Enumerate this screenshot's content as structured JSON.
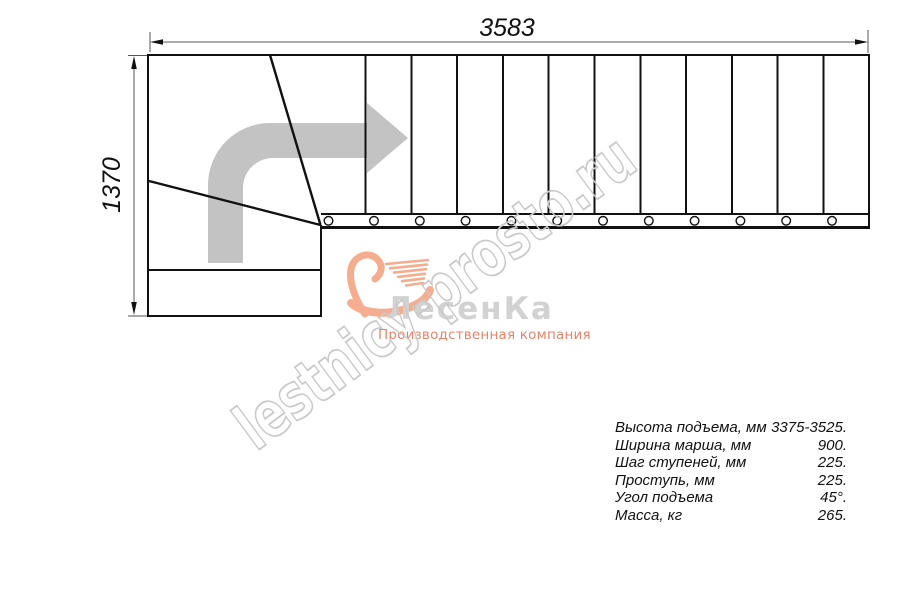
{
  "drawing": {
    "title": "staircase-top-view-plan",
    "dim_width_mm": "3583",
    "dim_height_mm": "1370",
    "straight_treads": 12,
    "baluster_count": 12,
    "line_color": "#111111",
    "dim_line_color": "#555555",
    "arrow_color": "#c3c3c3"
  },
  "watermark": {
    "text": "lestnicy-prosto.ru",
    "color": "#c9c9c9"
  },
  "logo": {
    "name": "ЛесенКа",
    "tagline": "Производственная компания",
    "name_color": "#d2d2d2",
    "tagline_color": "#e5836c",
    "swoosh_color": "#f5ad90"
  },
  "specs": {
    "rows": [
      {
        "label": "Высота подъема, мм",
        "value": "3375-3525."
      },
      {
        "label": "Ширина марша, мм",
        "value": "900."
      },
      {
        "label": "Шаг ступеней, мм",
        "value": "225."
      },
      {
        "label": "Проступь, мм",
        "value": "225."
      },
      {
        "label": "Угол подъема",
        "value": "45°."
      },
      {
        "label": "Масса, кг",
        "value": "265."
      }
    ]
  }
}
